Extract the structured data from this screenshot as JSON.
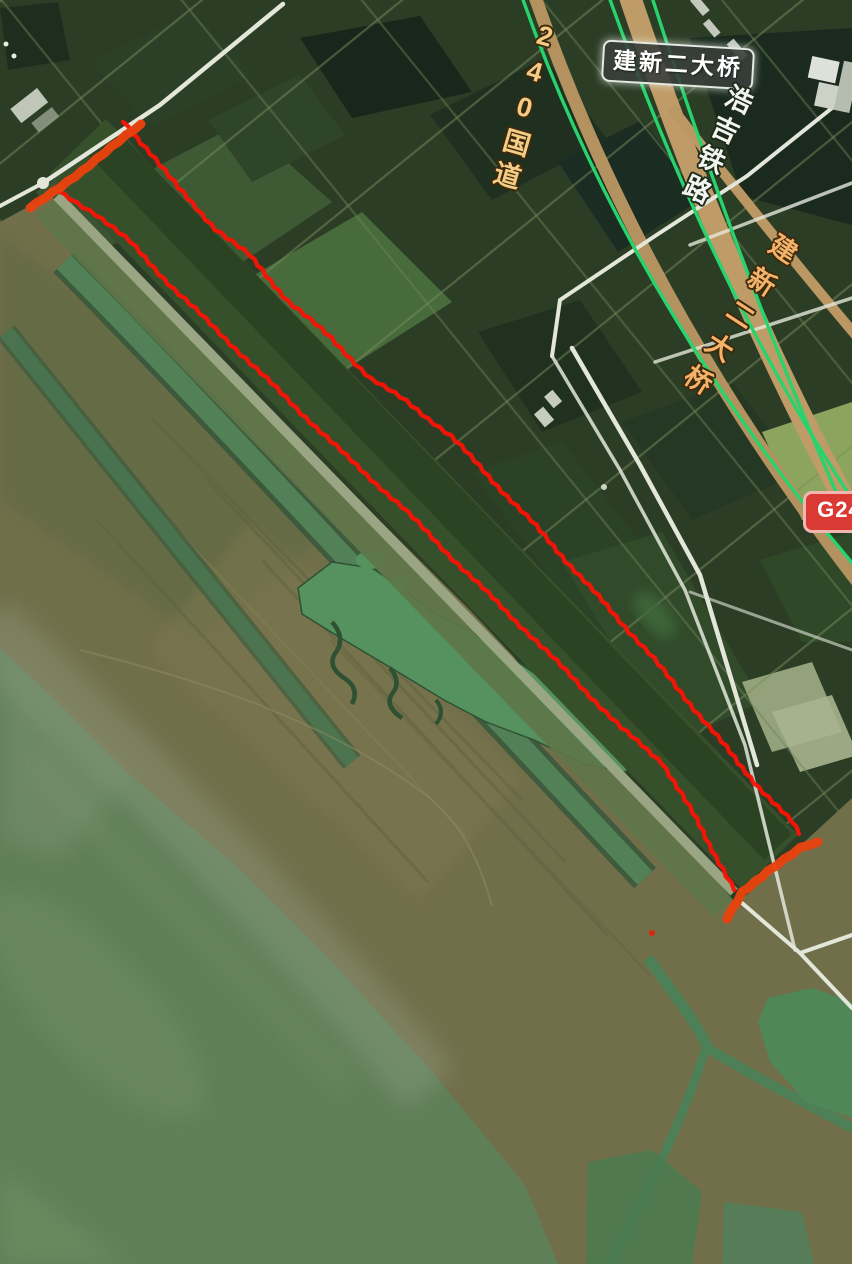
{
  "map_labels": {
    "bridge_badge": "建新二大桥",
    "national_road": "240国道",
    "railway": "浩吉铁路",
    "bridge_road": "建新二大桥",
    "route_badge": "G240"
  },
  "terrain_colors": {
    "farmland": "#2c3d26",
    "wetland": "#716f4a",
    "lake": "#5f7f58",
    "white_road": "#e3e7da",
    "tan_road": "#bf9c67",
    "railway_green": "#27d36d",
    "channel_green": "#538459"
  },
  "annotation": {
    "line_color": "#f71406",
    "cap_color": "#e9430e",
    "line_width": 4.3,
    "cap_width": 9,
    "left_line": [
      [
        58,
        191
      ],
      [
        96,
        214
      ],
      [
        130,
        242
      ],
      [
        174,
        289
      ],
      [
        231,
        344
      ],
      [
        286,
        398
      ],
      [
        346,
        456
      ],
      [
        402,
        507
      ],
      [
        463,
        569
      ],
      [
        521,
        626
      ],
      [
        576,
        681
      ],
      [
        621,
        728
      ],
      [
        663,
        763
      ],
      [
        696,
        819
      ],
      [
        723,
        869
      ],
      [
        734,
        890
      ]
    ],
    "right_line": [
      [
        123,
        122
      ],
      [
        151,
        153
      ],
      [
        178,
        188
      ],
      [
        216,
        229
      ],
      [
        249,
        255
      ],
      [
        288,
        301
      ],
      [
        331,
        338
      ],
      [
        371,
        379
      ],
      [
        406,
        401
      ],
      [
        451,
        436
      ],
      [
        493,
        481
      ],
      [
        531,
        521
      ],
      [
        571,
        566
      ],
      [
        611,
        611
      ],
      [
        649,
        653
      ],
      [
        681,
        693
      ],
      [
        713,
        731
      ],
      [
        738,
        763
      ],
      [
        759,
        787
      ],
      [
        773,
        802
      ],
      [
        791,
        821
      ],
      [
        799,
        834
      ]
    ],
    "top_cap": [
      [
        30,
        208
      ],
      [
        82,
        171
      ],
      [
        141,
        124
      ]
    ],
    "bottom_cap": [
      [
        727,
        919
      ],
      [
        742,
        892
      ],
      [
        768,
        871
      ],
      [
        801,
        848
      ],
      [
        818,
        842
      ]
    ],
    "dot": {
      "x": 652,
      "y": 933,
      "r": 3
    }
  }
}
